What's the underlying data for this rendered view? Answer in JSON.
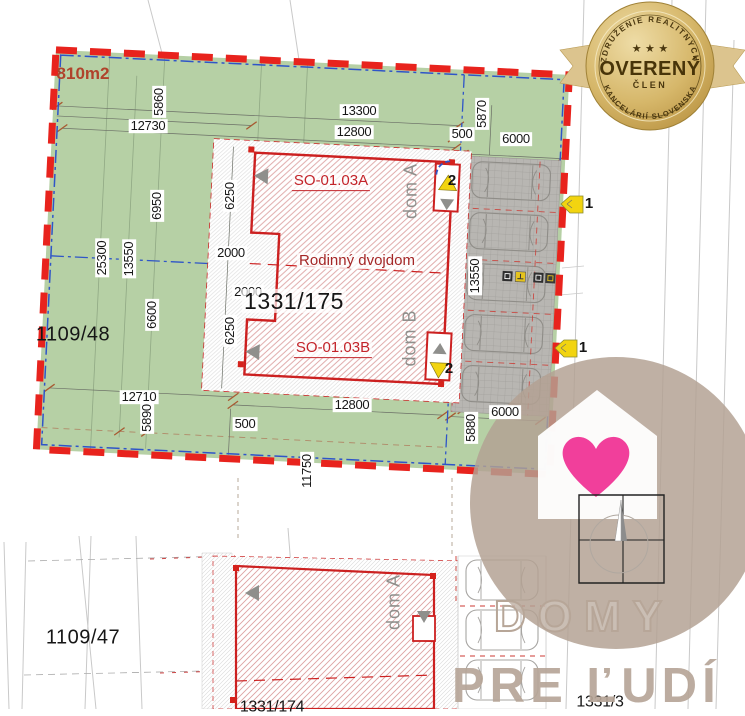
{
  "plan": {
    "area_label": "810m2",
    "duplex_title": "Rodinný dvojdom",
    "units": {
      "a_code": "SO-01.03A",
      "a_name": "dom A",
      "b_code": "SO-01.03B",
      "b_name": "dom B",
      "bottom_name": "dom A"
    },
    "parcels": {
      "main": "1331/175",
      "west": "1109/48",
      "south_west": "1109/47",
      "south_east": "1331/3",
      "south_partial": "1331/174"
    },
    "markers": {
      "entrance_top": "2",
      "entrance_bottom": "2",
      "street_top": "1",
      "street_bottom": "1"
    },
    "dims": {
      "d12730": "12730",
      "d5860": "5860",
      "d13300": "13300",
      "d12800_top": "12800",
      "d500_top": "500",
      "d5870": "5870",
      "d6000_top": "6000",
      "d6950": "6950",
      "d6250_top": "6250",
      "d2000_a": "2000",
      "d2000_b": "2000",
      "d6250_bottom": "6250",
      "d25300": "25300",
      "d13550_left": "13550",
      "d6600": "6600",
      "d13550_right": "13550",
      "d12710": "12710",
      "d5890": "5890",
      "d500_bottom": "500",
      "d12800_bottom": "12800",
      "d5880": "5880",
      "d11750": "11750",
      "d6000_bottom": "6000"
    }
  },
  "badge": {
    "arc_top": "ZDRUŽENIE REALITNÝCH",
    "arc_bottom": "KANCELÁRIÍ SLOVENSKA",
    "stars": "★ ★ ★",
    "title": "OVERENÝ",
    "subtitle": "ČLEN"
  },
  "watermark": {
    "line1": "DOMY",
    "line2": "PRE ĽUDÍ"
  },
  "colors": {
    "boundary_red": "#e8231d",
    "plot_green": "#b6d0a5",
    "cadastral_blue": "#2f55c8",
    "building_red": "#cc2020",
    "badge_gold": "#c9a551",
    "heart_pink": "#f13f9b",
    "watermark_beige": "#b7a698",
    "marker_yellow": "#f2d410"
  }
}
